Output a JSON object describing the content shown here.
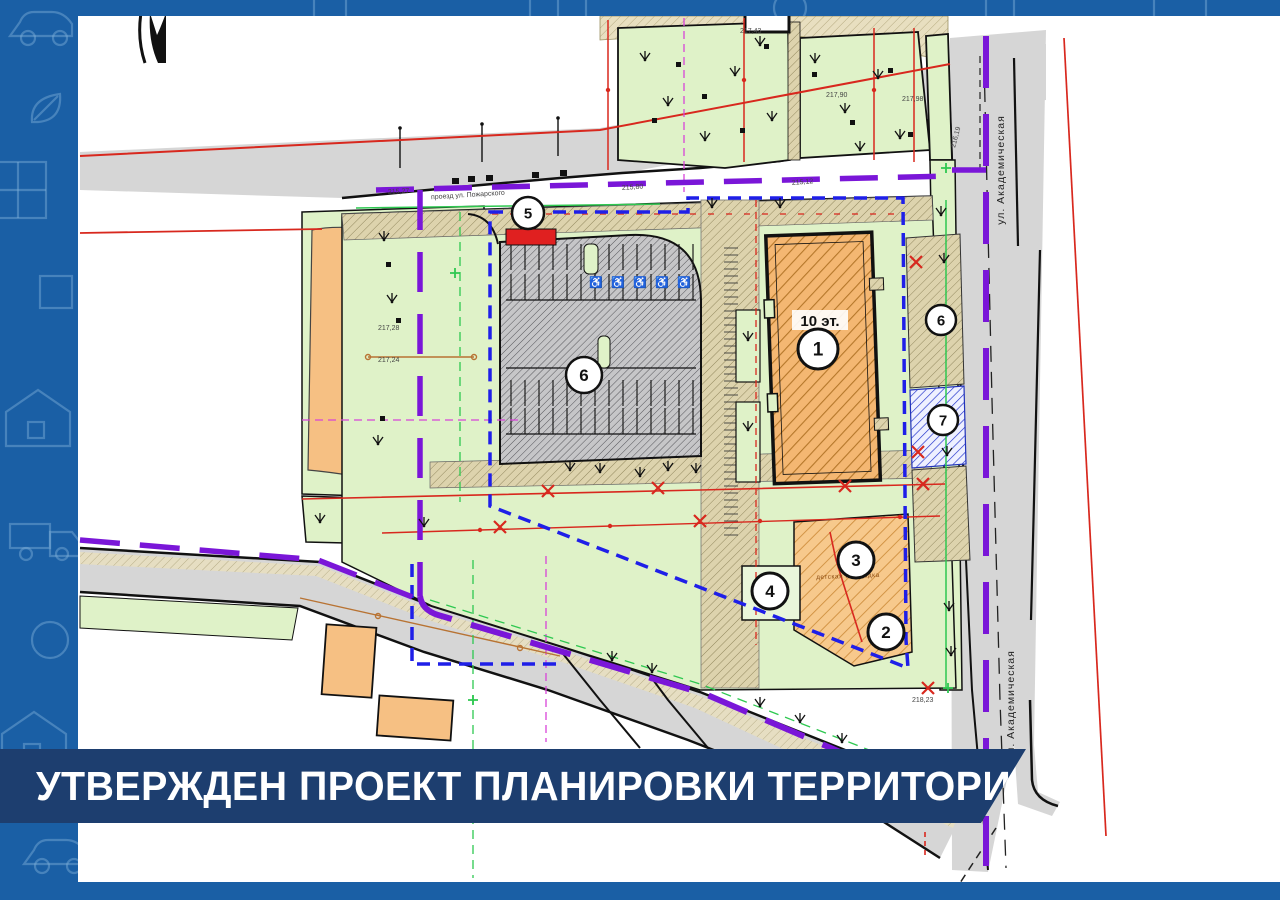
{
  "banner": {
    "text": "УТВЕРЖДЕН ПРОЕКТ ПЛАНИРОВКИ ТЕРРИТОРИИ"
  },
  "frame": {
    "pattern_icons": [
      "car-icon",
      "leaf-icon",
      "house-icon",
      "truck-icon",
      "square-icon",
      "grid-icon",
      "circle-icon"
    ]
  },
  "map": {
    "markers": [
      {
        "n": "1"
      },
      {
        "n": "2"
      },
      {
        "n": "3"
      },
      {
        "n": "4"
      },
      {
        "n": "5"
      },
      {
        "n": "6"
      },
      {
        "n": "6"
      },
      {
        "n": "7"
      }
    ],
    "labels": {
      "building1_floors": "10 эт.",
      "street_academicheskaya": "ул. Академическая",
      "street_proezd": "проезд ул. Пожарского",
      "playground": "детская площадка"
    },
    "elevations": [
      "215,27",
      "215,80",
      "215,12",
      "216,19",
      "217,43",
      "217,90",
      "217,98",
      "217,28",
      "217,24",
      "218,23"
    ],
    "accessible_symbol": "♿"
  },
  "colors": {
    "frame": "#1a5fa5",
    "banner": "#1d3e6f",
    "boundary": "#1f1fe8",
    "purple": "#7a16d8",
    "red": "#d8281e",
    "green": "#dff2c8",
    "green_bright": "#2ec850",
    "orange": "#f4b772",
    "parking": "#c6c6c8",
    "tan": "#ddd3ad",
    "road": "#d6d6d6",
    "magenta": "#d844d8",
    "brown": "#b87333",
    "blue_symbol": "#1a1acc"
  }
}
